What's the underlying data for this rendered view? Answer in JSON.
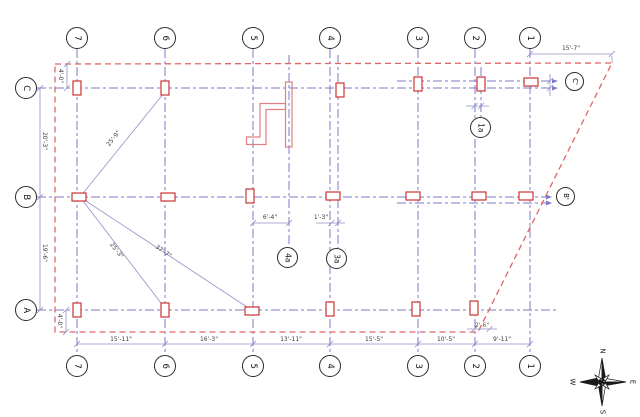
{
  "drawing": {
    "grid_columns": [
      "7",
      "6",
      "5",
      "4",
      "3",
      "2",
      "1"
    ],
    "grid_rows": [
      "C",
      "B",
      "A"
    ],
    "sub_grids": {
      "g4a": "4a",
      "g3a": "3a",
      "g1a": "1a"
    },
    "right_refs": {
      "c": "C'",
      "b": "B'"
    },
    "dims": {
      "top_right": "15'-7\"",
      "bottom": [
        "15'-11\"",
        "16'-3\"",
        "13'-11\"",
        "15'-5\"",
        "10'-5\"",
        "9'-11\""
      ],
      "left_top_offset": "4'-0\"",
      "left_c_b": "20'-3\"",
      "left_b_a": "19'-6\"",
      "left_bottom_offset": "4'-0\"",
      "stair_width": "6'-4\"",
      "grid4_3a": "1'-3\"",
      "grid2_edge": "2'-6\"",
      "brace_b7_c6": "25'-9\"",
      "brace_b7_a6": "25'-3\"",
      "brace_b7_a5": "37'-7\""
    },
    "compass": {
      "n": "N",
      "e": "E",
      "s": "S",
      "w": "W"
    },
    "colors": {
      "grid": "#7b7bc8",
      "boundary": "#e06666",
      "column": "#cc3333",
      "dimension": "#9090c8"
    }
  }
}
